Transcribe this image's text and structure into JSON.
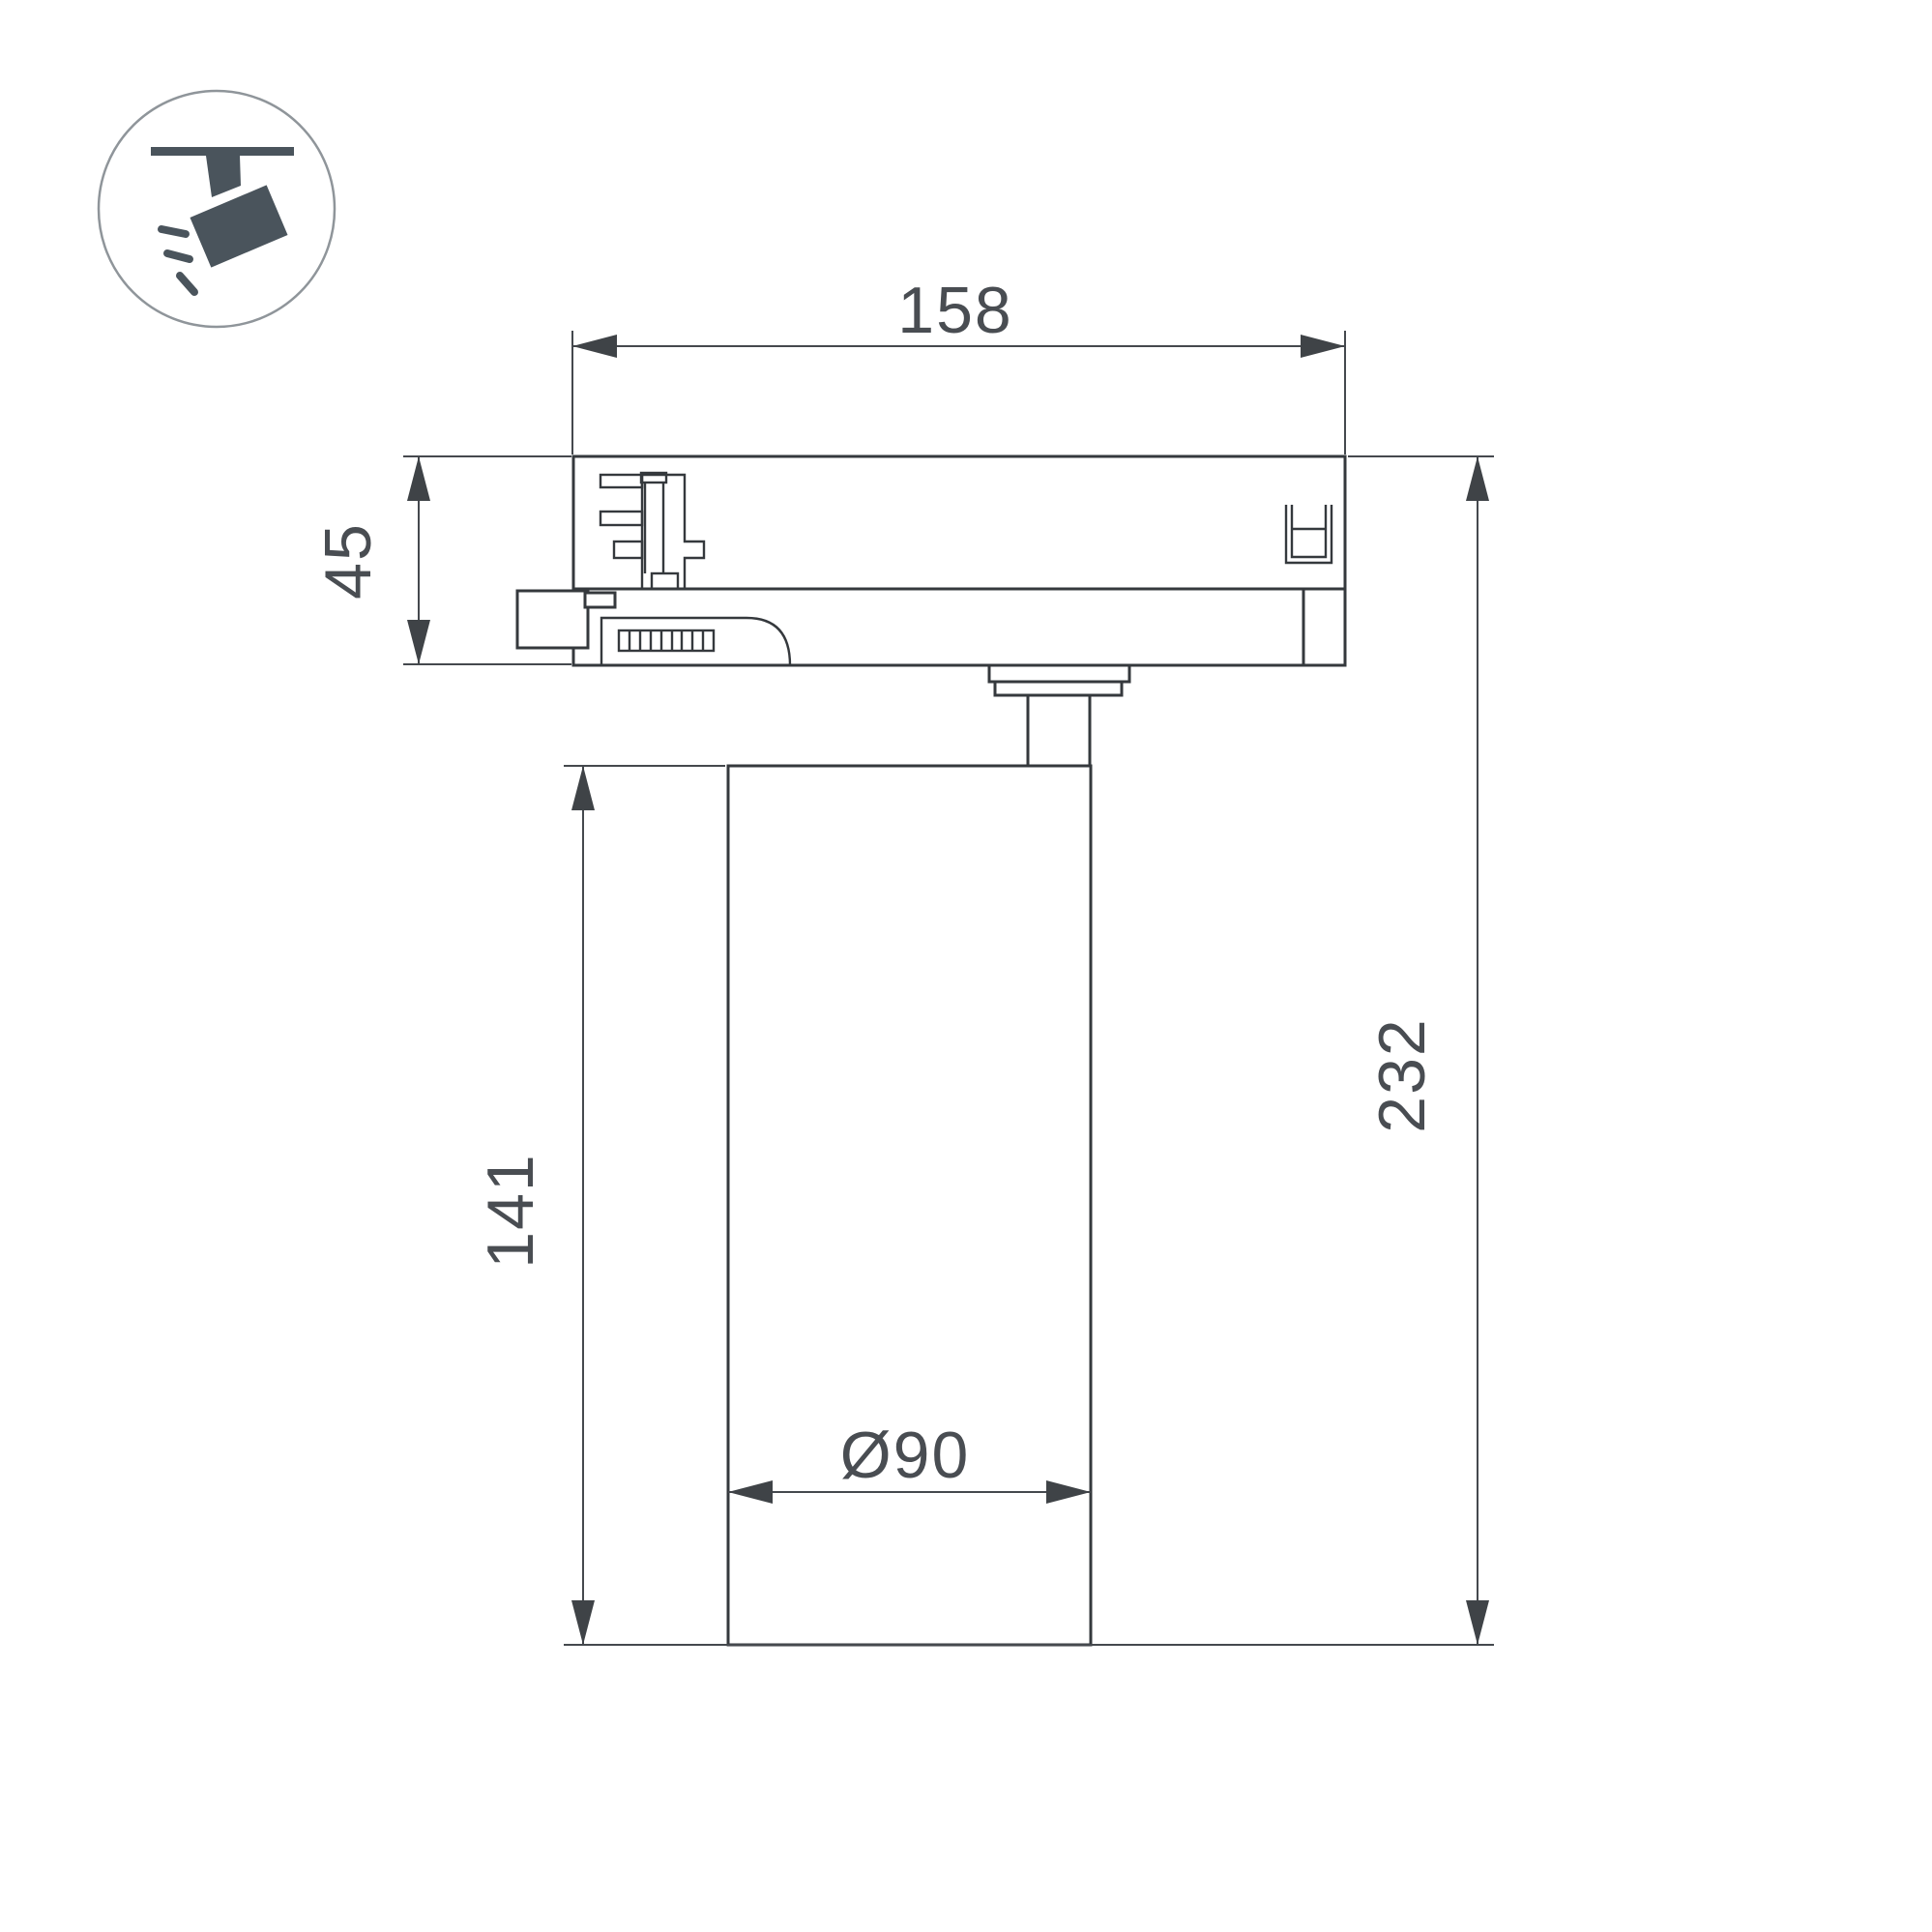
{
  "page": {
    "background": "#ffffff",
    "kind": "technical dimension drawing of a track-mounted spotlight"
  },
  "colors": {
    "object_outline": "#35393d",
    "dimension_lines": "#45494e",
    "dimension_text": "#494d52",
    "icon_glyph": "#4a545c",
    "icon_circle_outline": "#8f959a"
  },
  "icon": {
    "name": "track-spotlight-icon"
  },
  "dimensions": {
    "adapter_width": "158",
    "adapter_height": "45",
    "body_height": "141",
    "total_height": "232",
    "body_diameter": "Ø90"
  }
}
